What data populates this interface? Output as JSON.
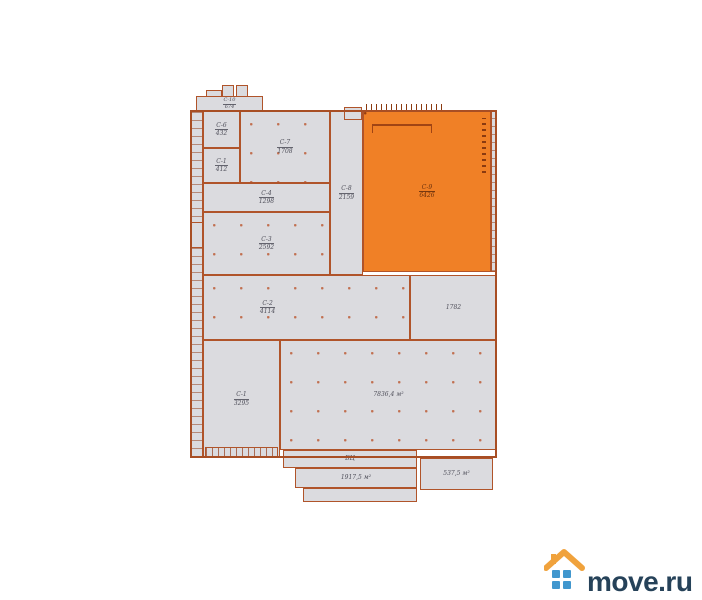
{
  "plan": {
    "title": "warehouse-floor-plan",
    "colors": {
      "wall": "#b0542a",
      "room_fill": "#dbdbdf",
      "highlight": "#f08026",
      "label": "#4f4f5a",
      "highlight_label": "#69300d"
    },
    "rooms": [
      {
        "name": "С-10",
        "area": "674"
      },
      {
        "name": "С-6",
        "area": "432"
      },
      {
        "name": "С-1",
        "area": "412"
      },
      {
        "name": "С-7",
        "area": "1708"
      },
      {
        "name": "С-4",
        "area": "1298"
      },
      {
        "name": "С-8",
        "area": "2159"
      },
      {
        "name": "С-3",
        "area": "2592"
      },
      {
        "name": "С-9",
        "area": "6426"
      },
      {
        "name": "С-2",
        "area": "4114"
      },
      {
        "name": "",
        "area": "1782"
      },
      {
        "name": "С-1",
        "area": "3295"
      },
      {
        "name": "",
        "area": "7836,4 м²"
      },
      {
        "name": "БЦ",
        "area": ""
      },
      {
        "name": "",
        "area": "1917,5 м²"
      },
      {
        "name": "",
        "area": "537,5 м²"
      }
    ]
  },
  "logo": {
    "text": "move.ru",
    "text_color": "#264259",
    "roof_color": "#f0a23c",
    "window_color": "#4197ce"
  }
}
